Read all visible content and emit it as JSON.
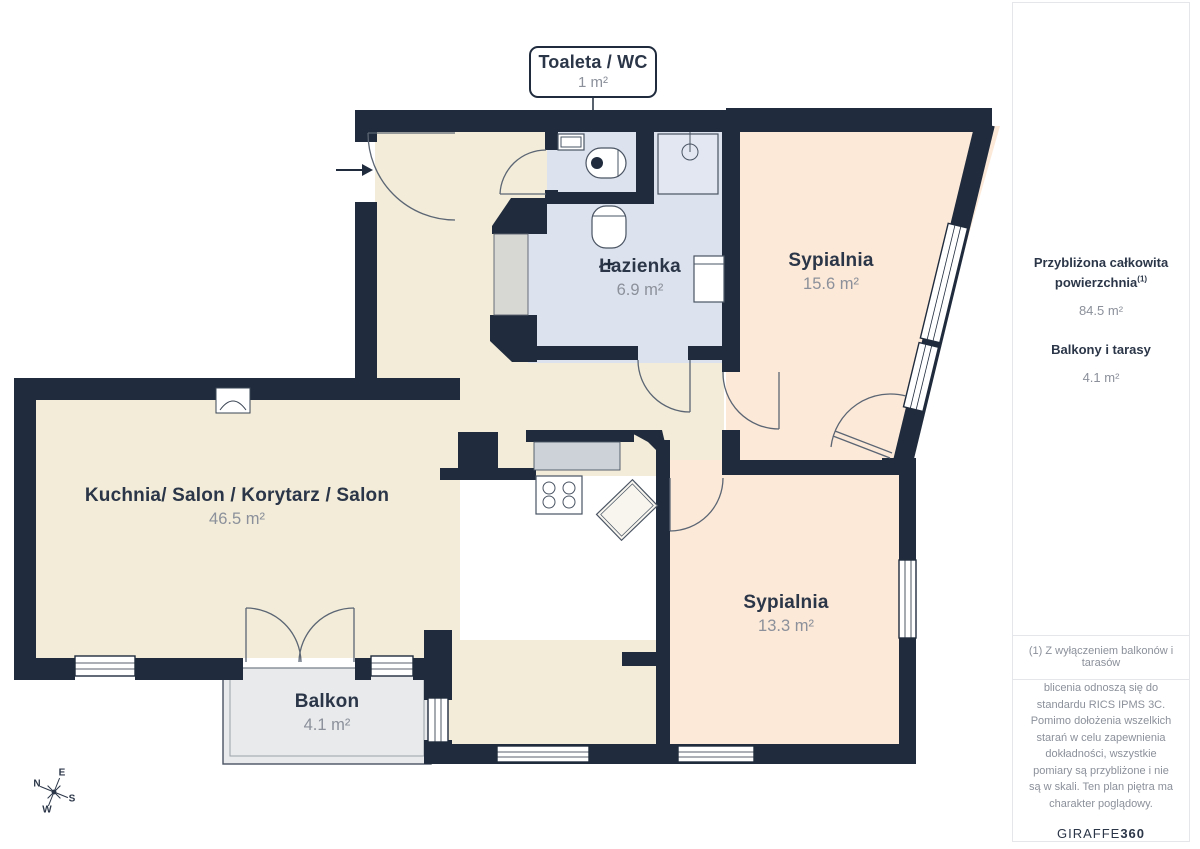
{
  "callout": {
    "title": "Toaleta / WC",
    "area": "1 m²"
  },
  "rooms": [
    {
      "name": "Łazienka",
      "area": "6.9 m²"
    },
    {
      "name": "Sypialnia",
      "area": "15.6 m²"
    },
    {
      "name": "Kuchnia/ Salon / Korytarz / Salon",
      "area": "46.5 m²"
    },
    {
      "name": "Sypialnia",
      "area": "13.3 m²"
    },
    {
      "name": "Balkon",
      "area": "4.1 m²"
    }
  ],
  "compass": {
    "n": "N",
    "e": "E",
    "s": "S",
    "w": "W"
  },
  "sidebar": {
    "total_label_line1": "Przybliżona całkowita",
    "total_label_line2": "powierzchnia",
    "total_superscript": "(1)",
    "total_value": "84.5 m²",
    "balconies_label": "Balkony i tarasy",
    "balconies_value": "4.1 m²",
    "footnote": "(1) Z wyłączeniem balkonów i tarasów",
    "disclaimer": "blicenia odnoszą się do standardu RICS IPMS 3C. Pomimo dołożenia wszelkich starań w celu zapewnienia dokładności, wszystkie pomiary są przybliżone i nie są w skali. Ten plan piętra ma charakter poglądowy.",
    "brand": {
      "name": "GIRAFFE",
      "suffix": "360"
    }
  },
  "colors": {
    "wall": "#202c3d",
    "cream": "#f2ecd9",
    "peach": "#fce9d8",
    "blue": "#dde3ee",
    "balcony": "#e8eaec",
    "accentText": "#2b3648",
    "mutedText": "#8b909a",
    "furnline": "#4a5463",
    "doorline": "#5b6573",
    "border": "#e4e6e9"
  }
}
